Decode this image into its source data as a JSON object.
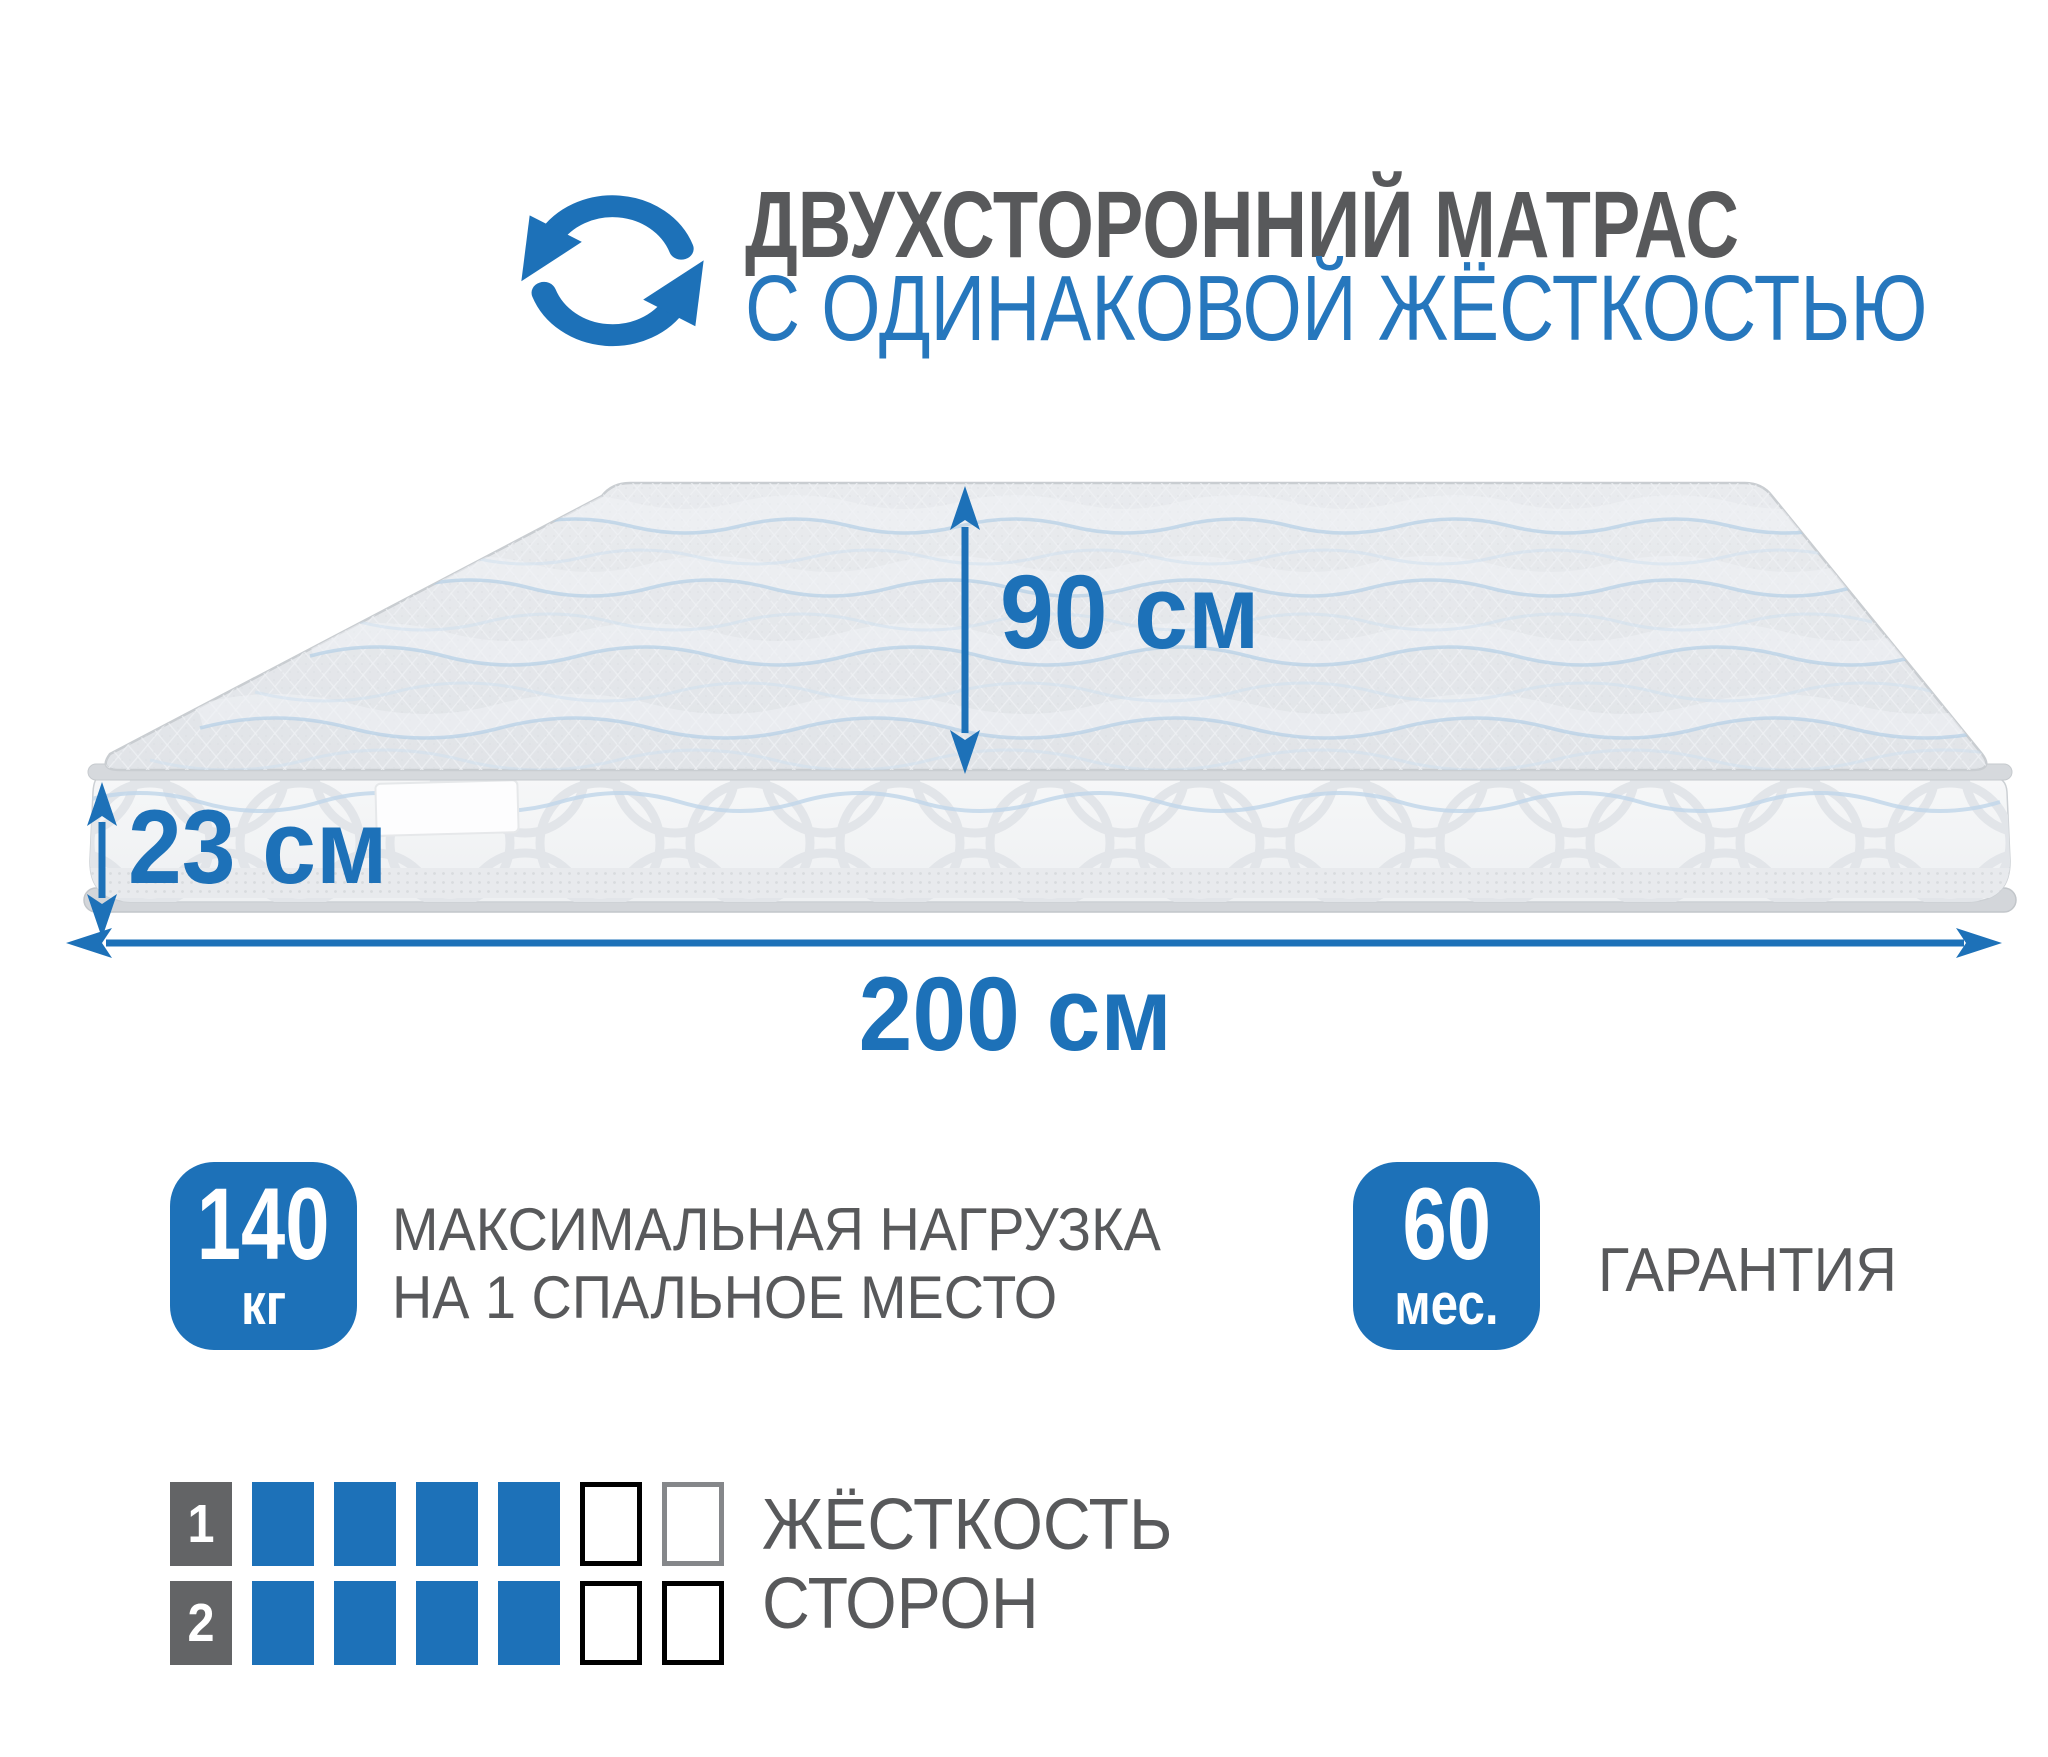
{
  "colors": {
    "accent_blue": "#1d71b8",
    "title_gray": "#58595b",
    "title_blue": "#2677bd",
    "number_square_gray": "#636466"
  },
  "header": {
    "icon": "rotate-arrows-icon",
    "title_line1": "ДВУХСТОРОННИЙ МАТРАС",
    "title_line2": "С ОДИНАКОВОЙ ЖЁСТКОСТЬЮ"
  },
  "mattress_diagram": {
    "width_label": "90 см",
    "thickness_label": "23 см",
    "length_label": "200 см"
  },
  "features": [
    {
      "badge_value": "140",
      "badge_unit": "кг",
      "text_line1": "МАКСИМАЛЬНАЯ НАГРУЗКА",
      "text_line2": "НА 1 СПАЛЬНОЕ МЕСТО"
    },
    {
      "badge_value": "60",
      "badge_unit": "мес.",
      "text_line1": "ГАРАНТИЯ",
      "text_line2": ""
    }
  ],
  "hardness_scale": {
    "label_line1": "ЖЁСТКОСТЬ",
    "label_line2": "СТОРОН",
    "max": 6,
    "rows": [
      {
        "number": "1",
        "filled": 4,
        "cells": [
          "filled",
          "filled",
          "filled",
          "filled",
          "empty-dark",
          "empty-gray"
        ]
      },
      {
        "number": "2",
        "filled": 4,
        "cells": [
          "filled",
          "filled",
          "filled",
          "filled",
          "empty-dark",
          "empty-dark"
        ]
      }
    ]
  }
}
